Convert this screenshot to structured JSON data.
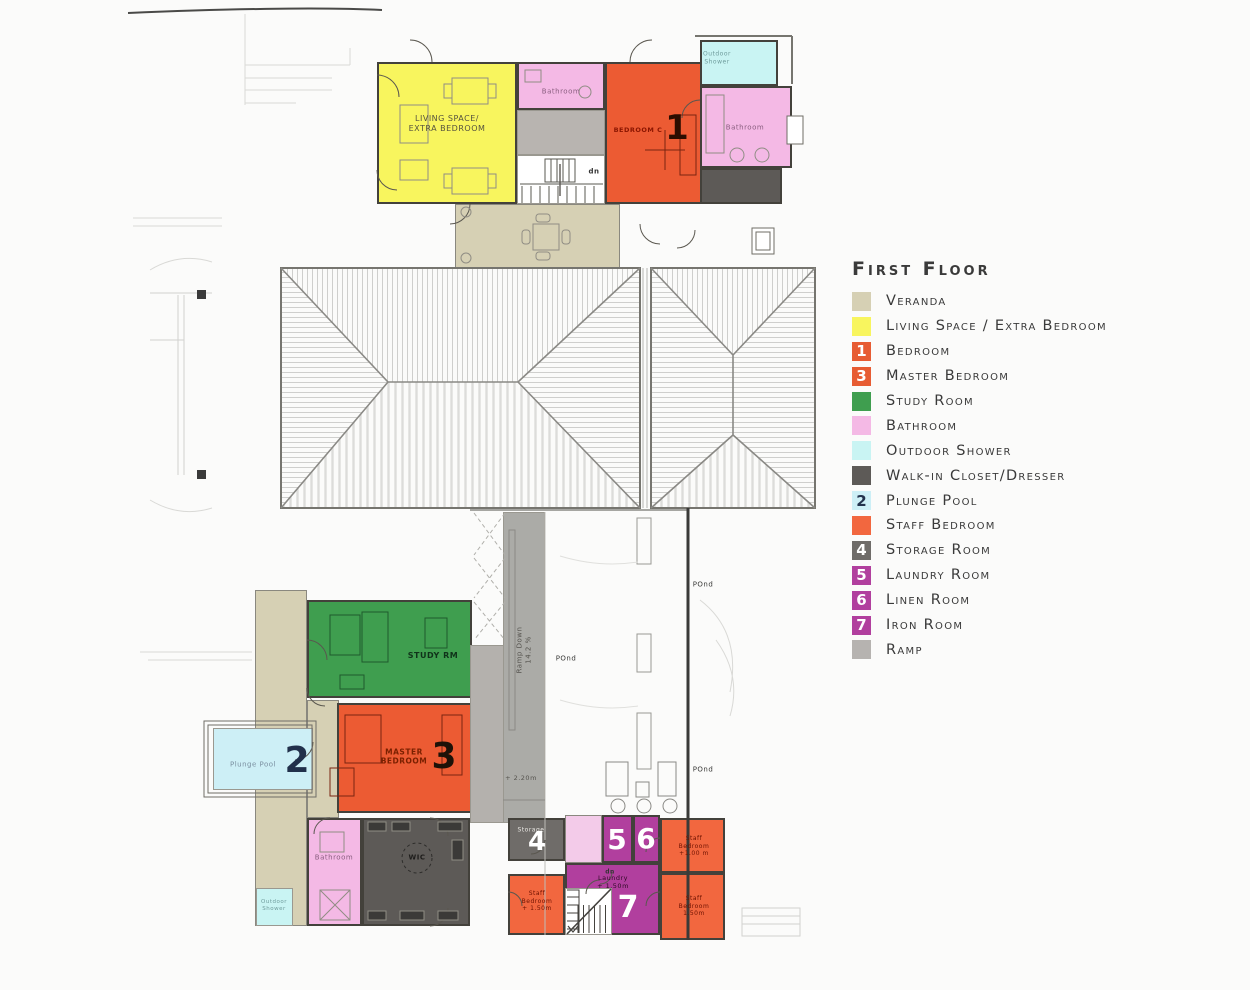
{
  "legend": {
    "title": "First Floor",
    "items": [
      {
        "label": "Veranda",
        "color": "#d6d0b4",
        "number": "",
        "number_color": "#ffffff"
      },
      {
        "label": "Living Space / Extra Bedroom",
        "color": "#f8f55e",
        "number": "",
        "number_color": "#ffffff"
      },
      {
        "label": "Bedroom",
        "color": "#e75c33",
        "number": "1",
        "number_color": "#ffffff"
      },
      {
        "label": "Master Bedroom",
        "color": "#e75c33",
        "number": "3",
        "number_color": "#ffffff"
      },
      {
        "label": "Study Room",
        "color": "#3f9e4f",
        "number": "",
        "number_color": "#ffffff"
      },
      {
        "label": "Bathroom",
        "color": "#f4b9e5",
        "number": "",
        "number_color": "#ffffff"
      },
      {
        "label": "Outdoor Shower",
        "color": "#c9f4f3",
        "number": "",
        "number_color": "#ffffff"
      },
      {
        "label": "Walk-in Closet/Dresser",
        "color": "#5d5a57",
        "number": "",
        "number_color": "#ffffff"
      },
      {
        "label": "Plunge Pool",
        "color": "#cdeff6",
        "number": "2",
        "number_color": "#23324d"
      },
      {
        "label": "Staff Bedroom",
        "color": "#f2673f",
        "number": "",
        "number_color": "#ffffff"
      },
      {
        "label": "Storage Room",
        "color": "#6f6c69",
        "number": "4",
        "number_color": "#ffffff"
      },
      {
        "label": "Laundry Room",
        "color": "#b13f9e",
        "number": "5",
        "number_color": "#ffffff"
      },
      {
        "label": "Linen Room",
        "color": "#b13f9e",
        "number": "6",
        "number_color": "#ffffff"
      },
      {
        "label": "Iron Room",
        "color": "#b13f9e",
        "number": "7",
        "number_color": "#ffffff"
      },
      {
        "label": "Ramp",
        "color": "#b6b3b0",
        "number": "",
        "number_color": "#ffffff"
      }
    ]
  },
  "rooms": {
    "living": {
      "label": "LIVING SPACE/\nEXTRA BEDROOM"
    },
    "bath_top": {
      "label": "Bathroom"
    },
    "bedroom1": {
      "label": "BEDROOM C",
      "number": "1"
    },
    "shower_top": {
      "label": "Outdoor\nShower"
    },
    "bath_right": {
      "label": "Bathroom"
    },
    "study": {
      "label": "STUDY RM"
    },
    "master": {
      "label": "MASTER\nBEDROOM",
      "number": "3"
    },
    "plunge": {
      "label": "Plunge Pool",
      "number": "2"
    },
    "bath_bottom": {
      "label": "Bathroom"
    },
    "wic": {
      "label": "WIC"
    },
    "shower_bottom": {
      "label": "Outdoor\nShower"
    },
    "storage": {
      "label": "Storage",
      "number": "4"
    },
    "laundry5": {
      "number": "5"
    },
    "linen6": {
      "number": "6"
    },
    "staff_tr": {
      "label": "Staff\nBedroom\n+1.00 m"
    },
    "laundry7": {
      "label": "Laundry\n+ 1.50m",
      "number": "7"
    },
    "staff_left": {
      "label": "Staff\nBedroom\n+ 1.50m"
    },
    "staff_br": {
      "label": "Staff\nBedroom\n1.50m"
    }
  },
  "annotations": {
    "ramp": "Ramp Down\n14.2 %",
    "ramp_level": "+ 2.20m",
    "pond": "POnd",
    "down": "dn"
  },
  "colors": {
    "veranda": "#d6d0b4",
    "living": "#f8f55e",
    "bedroom": "#ec5b33",
    "staff": "#f2673f",
    "study": "#3f9e4f",
    "bathroom": "#f4b9e5",
    "bathroom_pale": "#f3cbe9",
    "shower": "#c9f4f3",
    "plunge": "#cdeff6",
    "closet": "#5d5a57",
    "storage": "#6f6c69",
    "laundry": "#b13f9e",
    "ramp": "#ababa7",
    "walkway": "#b4b1ad",
    "corridor": "#b8b4b0",
    "wall": "#43413b",
    "background": "#fbfbfa"
  }
}
